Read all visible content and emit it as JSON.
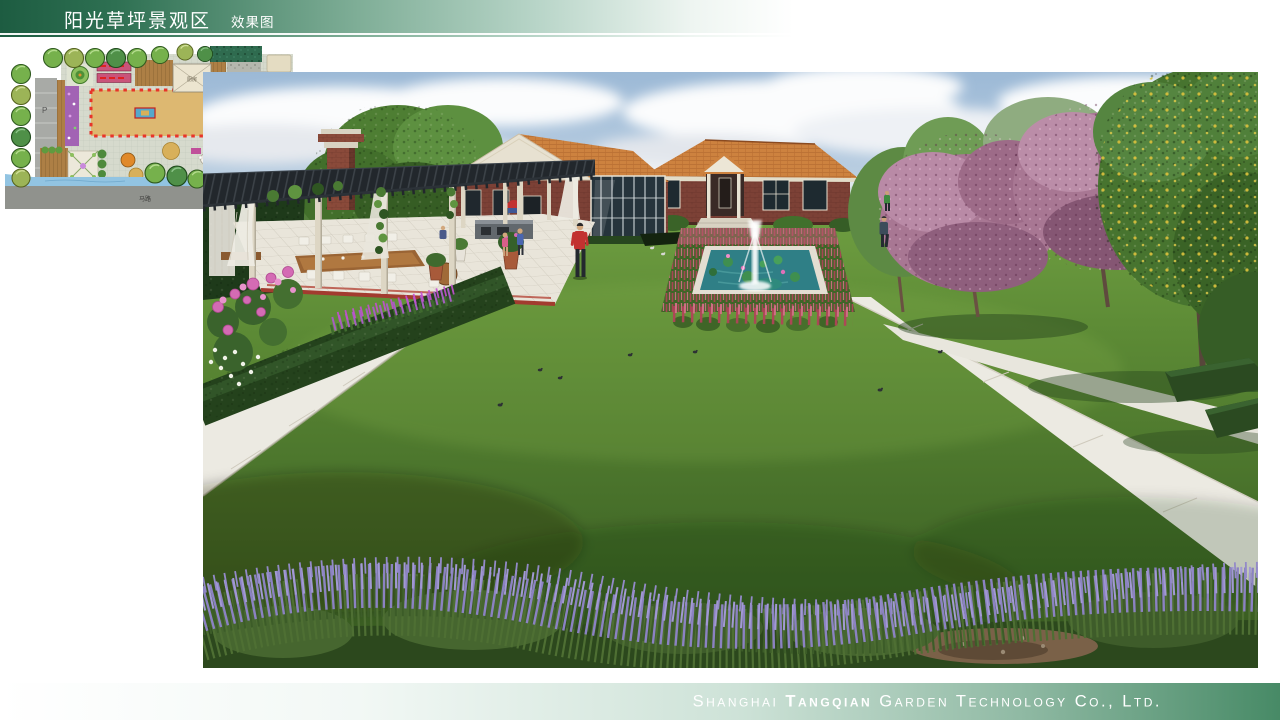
{
  "header": {
    "title": "阳光草坪景观区",
    "subtitle": "效果图"
  },
  "site_plan": {
    "labels": {
      "kitchen": "厨房",
      "building": "建筑",
      "road": "马路",
      "north": "北",
      "parking": "P"
    },
    "highlight_color": "#e8342a"
  },
  "footer": {
    "company_prefix": "Shanghai",
    "company_emphasis": "Tangqian",
    "company_suffix": "Garden Technology Co., Ltd."
  },
  "colors": {
    "header_green": "#1d5c41",
    "footer_green": "#478a66",
    "lawn_green": "#5c8a35",
    "roof_orange": "#cd823f",
    "brick_red": "#7c4136",
    "lavender_purple": "#8b82c2",
    "flower_crimson": "#b04458",
    "pond_teal": "#2f7f86",
    "blossom_pink": "#a87793"
  }
}
